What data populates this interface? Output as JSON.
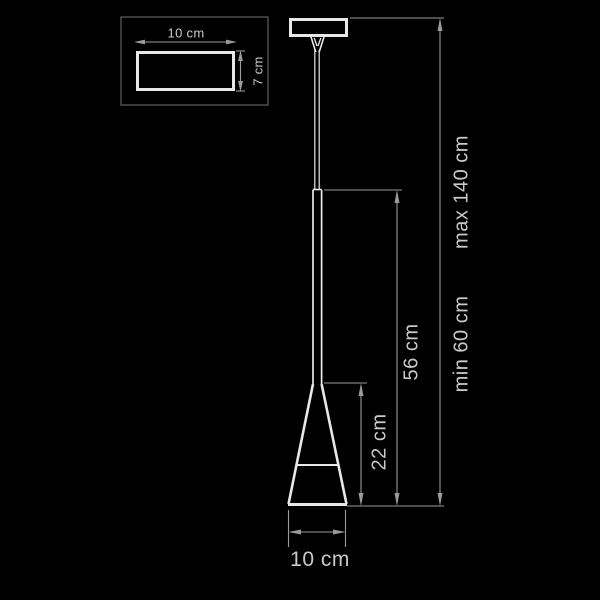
{
  "colors": {
    "background": "#000000",
    "lamp_line": "#e8e8e8",
    "dimension_line": "#9a9a9a",
    "text_color": "#c9c9c9",
    "inset_border": "#5f5f5f"
  },
  "diagram_title": "pendant-lamp-dimension-drawing",
  "inset": {
    "width_label": "10 cm",
    "height_label": "7 cm"
  },
  "dimensions": {
    "shade_height": "22 cm",
    "fixture_height": "56 cm",
    "overall_min": "min 60 cm",
    "overall_max": "max 140 cm",
    "shade_diameter": "10 cm"
  }
}
